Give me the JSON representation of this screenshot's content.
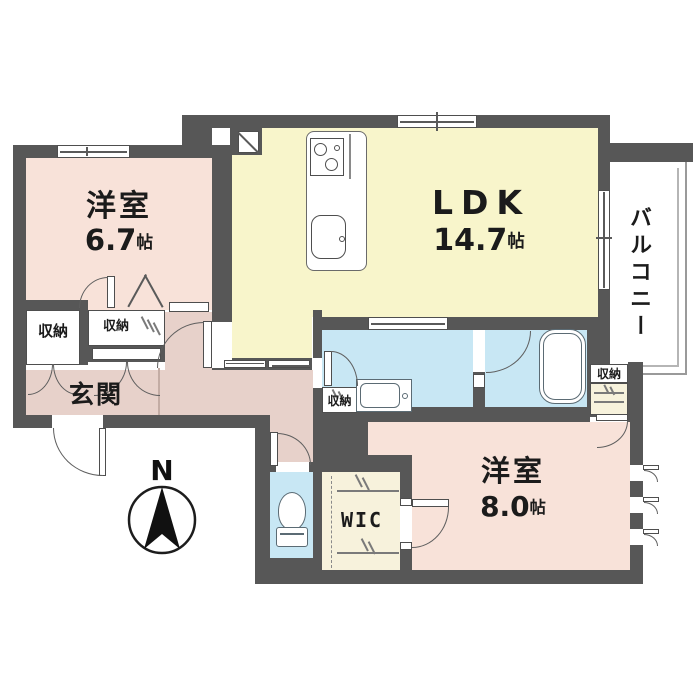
{
  "rooms": {
    "west1": {
      "name": "洋室",
      "area": "6.7",
      "unit": "帖"
    },
    "ldk": {
      "name": "LDK",
      "area": "14.7",
      "unit": "帖"
    },
    "west2": {
      "name": "洋室",
      "area": "8.0",
      "unit": "帖"
    },
    "balcony": {
      "name": "バルコニー"
    },
    "entrance": {
      "name": "玄関"
    },
    "wic": {
      "name": "WIC"
    }
  },
  "storages": {
    "left": "収納",
    "hall": "収納",
    "washroom": "収納",
    "bedroom": "収納"
  },
  "compass": {
    "north": "N"
  },
  "colors": {
    "wall": "#575757",
    "room_pink": "#f8e2d9",
    "corridor_mauve": "#e7d1ca",
    "ldk_yellow": "#f8f5cb",
    "water_blue": "#c8e7f4",
    "wic_cream": "#f7f2dc"
  }
}
